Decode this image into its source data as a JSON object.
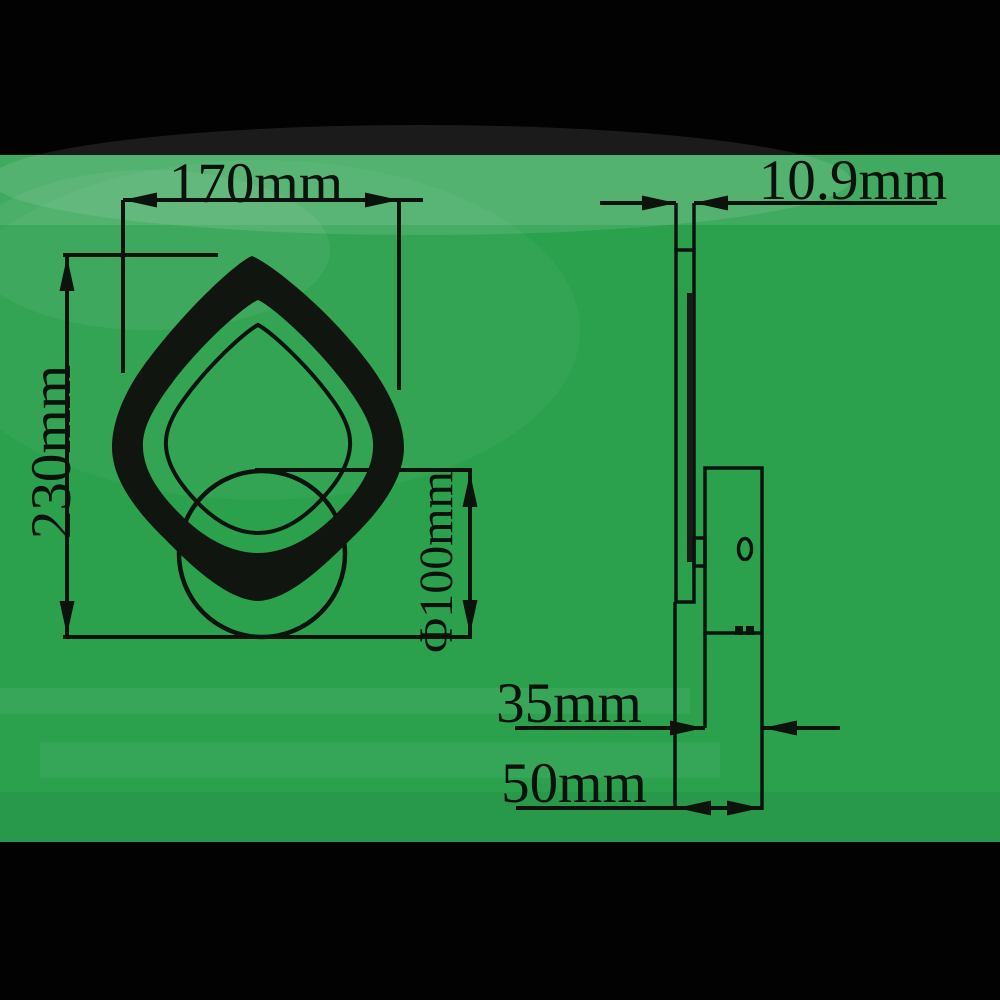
{
  "figure": {
    "kind": "wall-lamp-dimension-drawing",
    "colors": {
      "backdrop": "#000000",
      "paper": "#2ba14e",
      "ink": "#0c130d"
    },
    "front_view": {
      "width_label": "170mm",
      "height_label": "230mm",
      "mount_diameter_label": "Φ100mm"
    },
    "side_view": {
      "thickness_label": "10.9mm",
      "canopy_depth_label": "35mm",
      "total_depth_label": "50mm"
    }
  }
}
